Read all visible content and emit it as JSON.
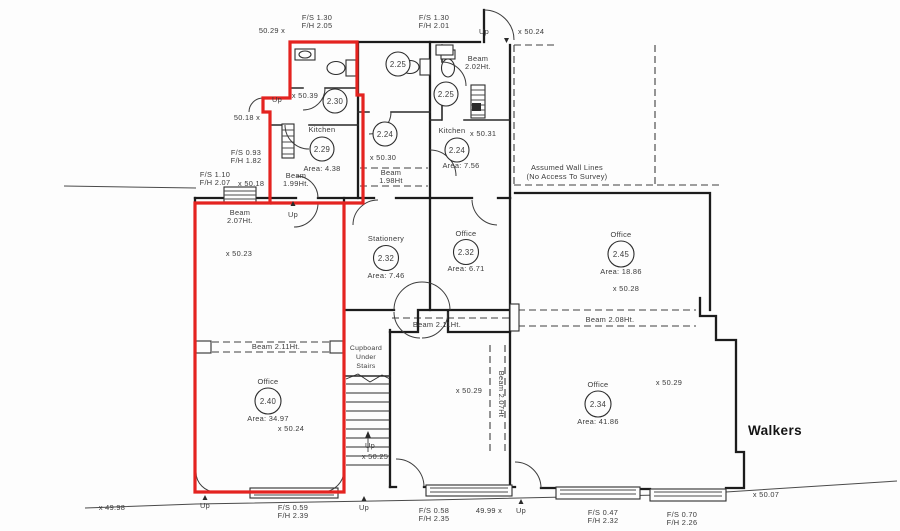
{
  "brand": {
    "walkers": "Walkers"
  },
  "notes": {
    "assumed_line1": "Assumed Wall Lines",
    "assumed_line2": "(No Access To Survey)"
  },
  "rooms": {
    "kitchen_229": {
      "name": "Kitchen",
      "number": "2.29",
      "area": "Area:  4.38"
    },
    "kitchen_224": {
      "name": "Kitchen",
      "number": "2.24",
      "area": "Area:  7.56",
      "level": "x  50.31"
    },
    "stationery_232": {
      "name": "Stationery",
      "number": "2.32",
      "area": "Area:  7.46"
    },
    "office_232": {
      "name": "Office",
      "number": "2.32",
      "area": "Area:  6.71"
    },
    "office_245": {
      "name": "Office",
      "number": "2.45",
      "area": "Area:  18.86",
      "level": "x  50.28"
    },
    "office_240": {
      "name": "Office",
      "number": "2.40",
      "area": "Area:  34.97",
      "level": "x  50.24"
    },
    "office_234": {
      "name": "Office",
      "number": "2.34",
      "area": "Area:  41.86",
      "level": "x  50.29"
    },
    "wc_225a": {
      "number": "2.25"
    },
    "wc_225b": {
      "number": "2.25"
    },
    "room_230": {
      "number": "2.30"
    },
    "room_224": {
      "number": "2.24"
    },
    "cupboard": {
      "l1": "Cupboard",
      "l2": "Under",
      "l3": "Stairs"
    }
  },
  "doors": {
    "top_left": {
      "fs": "F/S  1.30",
      "fh": "F/H  2.05"
    },
    "top_mid": {
      "fs": "F/S  1.30",
      "fh": "F/H  2.01"
    },
    "left_upper": {
      "fs": "F/S  0.93",
      "fh": "F/H  1.82"
    },
    "left_lower": {
      "fs": "F/S  1.10",
      "fh": "F/H  2.07"
    },
    "bottom_1": {
      "fs": "F/S  0.59",
      "fh": "F/H  2.39"
    },
    "bottom_2": {
      "fs": "F/S  0.58",
      "fh": "F/H  2.35"
    },
    "bottom_3": {
      "fs": "F/S  0.47",
      "fh": "F/H  2.32"
    },
    "bottom_4": {
      "fs": "F/S  0.70",
      "fh": "F/H  2.26"
    }
  },
  "beams": {
    "b202_l1": "Beam",
    "b202_l2": "2.02Ht.",
    "b199_l1": "Beam",
    "b199_l2": "1.99Ht.",
    "b198_l1": "Beam",
    "b198_l2": "1.98Ht",
    "b207_left_l1": "Beam",
    "b207_left_l2": "2.07Ht.",
    "b211_left": "Beam  2.11Ht.",
    "b211_mid": "Beam  2.11Ht.",
    "b208": "Beam  2.08Ht.",
    "b207_vert": "Beam  2.07Ht"
  },
  "levels": {
    "l5029_tl": "50.29  x",
    "l5024_tr": "x  50.24",
    "l5039": "x  50.39",
    "l5018_top": "50.18  x",
    "l5030": "x  50.30",
    "l5018_left": "x  50.18",
    "l5023": "x  50.23",
    "l5029_c": "x  50.29",
    "l5025": "x  50.25",
    "l4998": "x  49.98",
    "l4999": "49.99  x",
    "l5007": "x  50.07"
  },
  "nav": {
    "up": "Up"
  }
}
